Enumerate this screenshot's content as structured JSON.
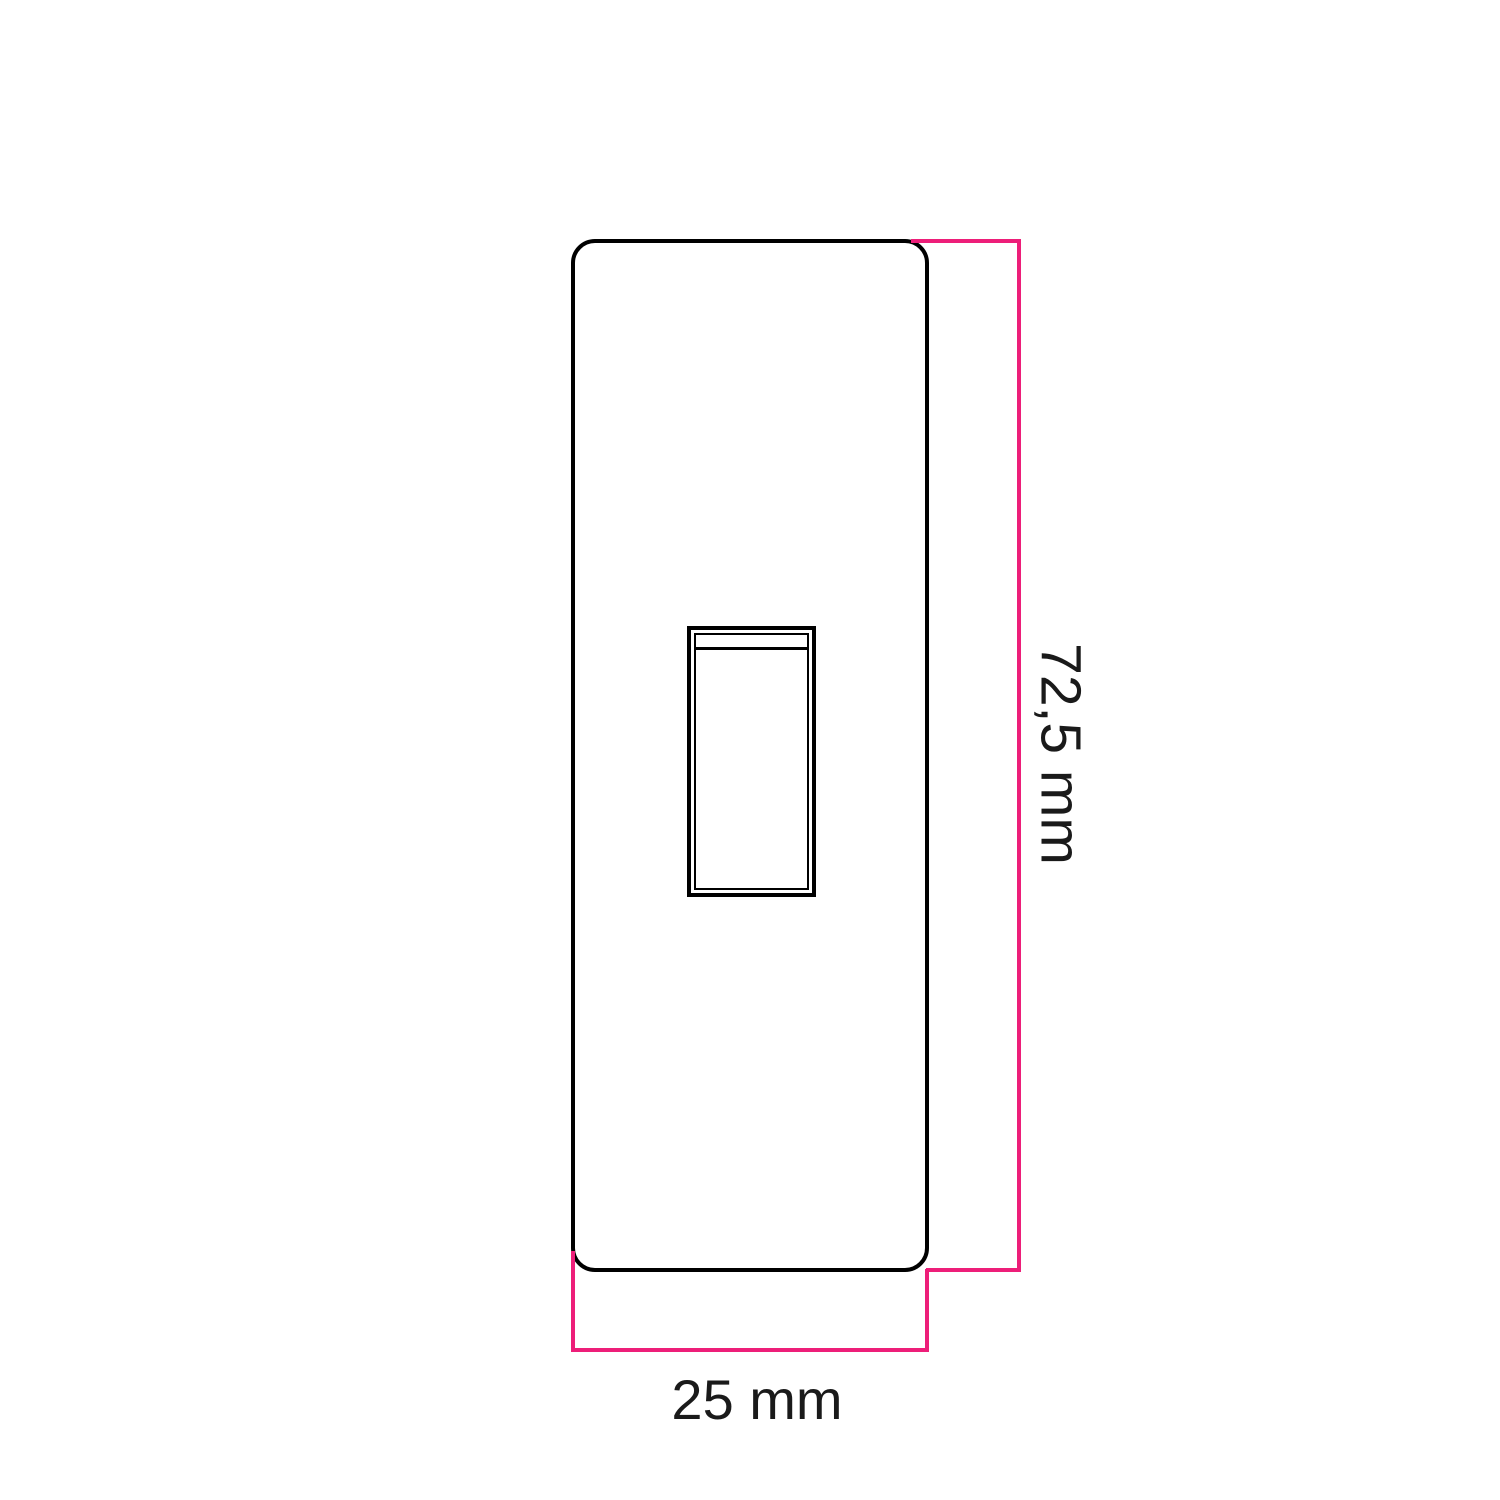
{
  "page": {
    "background": "#ffffff",
    "description": "Technical dimension drawing of a rectangular rocker-switch front plate"
  },
  "diagram": {
    "object": "rocker-switch-front-plate",
    "dimensions": {
      "height": {
        "label": "72,5 mm",
        "value": "72,5",
        "unit": "mm"
      },
      "width": {
        "label": "25 mm",
        "value": "25",
        "unit": "mm"
      }
    },
    "colors": {
      "outline": "#000000",
      "dimension_line": "#ED1E79",
      "label_text": "#1a1a1a"
    }
  }
}
